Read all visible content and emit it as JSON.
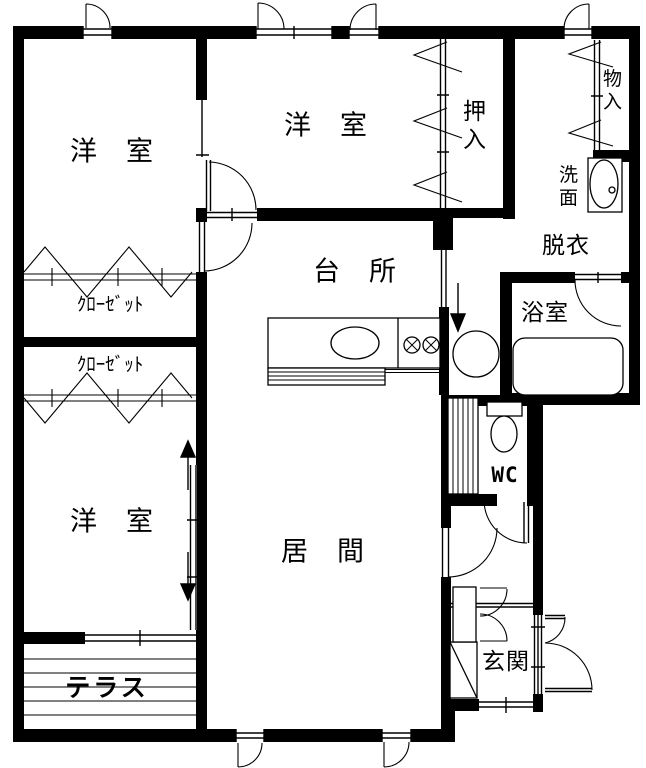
{
  "colors": {
    "line": "#000000",
    "background": "#ffffff"
  },
  "rooms": {
    "bedroom1": "洋　室",
    "bedroom2": "洋　室",
    "bedroom3": "洋　室",
    "closet1": "ｸﾛｰｾﾞｯﾄ",
    "closet2": "ｸﾛｰｾﾞｯﾄ",
    "oshiire": "押\n入",
    "storage": "物\n入",
    "washstand": "洗\n面",
    "dressing": "脱衣",
    "bath": "浴室",
    "kitchen": "台　所",
    "living": "居　間",
    "wc": "WC",
    "entrance": "玄関",
    "terrace": "テラス"
  }
}
